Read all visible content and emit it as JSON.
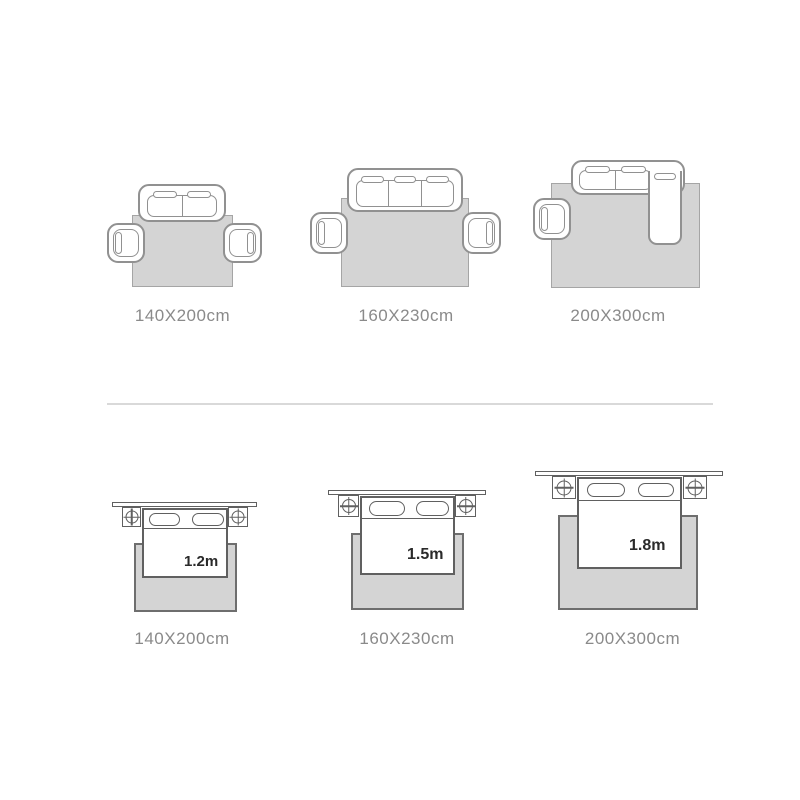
{
  "top_row": {
    "items": [
      {
        "type": "sofa",
        "seats": 2,
        "armchairs": 2,
        "label": "140X200cm"
      },
      {
        "type": "sofa",
        "seats": 3,
        "armchairs": 2,
        "label": "160X230cm"
      },
      {
        "type": "sectional-sofa",
        "seats": 3,
        "armchairs": 1,
        "label": "200X300cm"
      }
    ]
  },
  "bottom_row": {
    "items": [
      {
        "type": "bed",
        "bed_width": "1.2m",
        "label": "140X200cm"
      },
      {
        "type": "bed",
        "bed_width": "1.5m",
        "label": "160X230cm"
      },
      {
        "type": "bed",
        "bed_width": "1.8m",
        "label": "200X300cm"
      }
    ]
  },
  "colors": {
    "background": "#ffffff",
    "rug_fill": "#d4d4d4",
    "rug_border_top_row": "#a5a5a5",
    "rug_border_bottom_row": "#6e6e6e",
    "line_top_row": "#919191",
    "line_bottom_row": "#606060",
    "label_text": "#8a8a8a",
    "bed_size_text": "#2a2a2a",
    "divider": "#d9d9d9"
  }
}
